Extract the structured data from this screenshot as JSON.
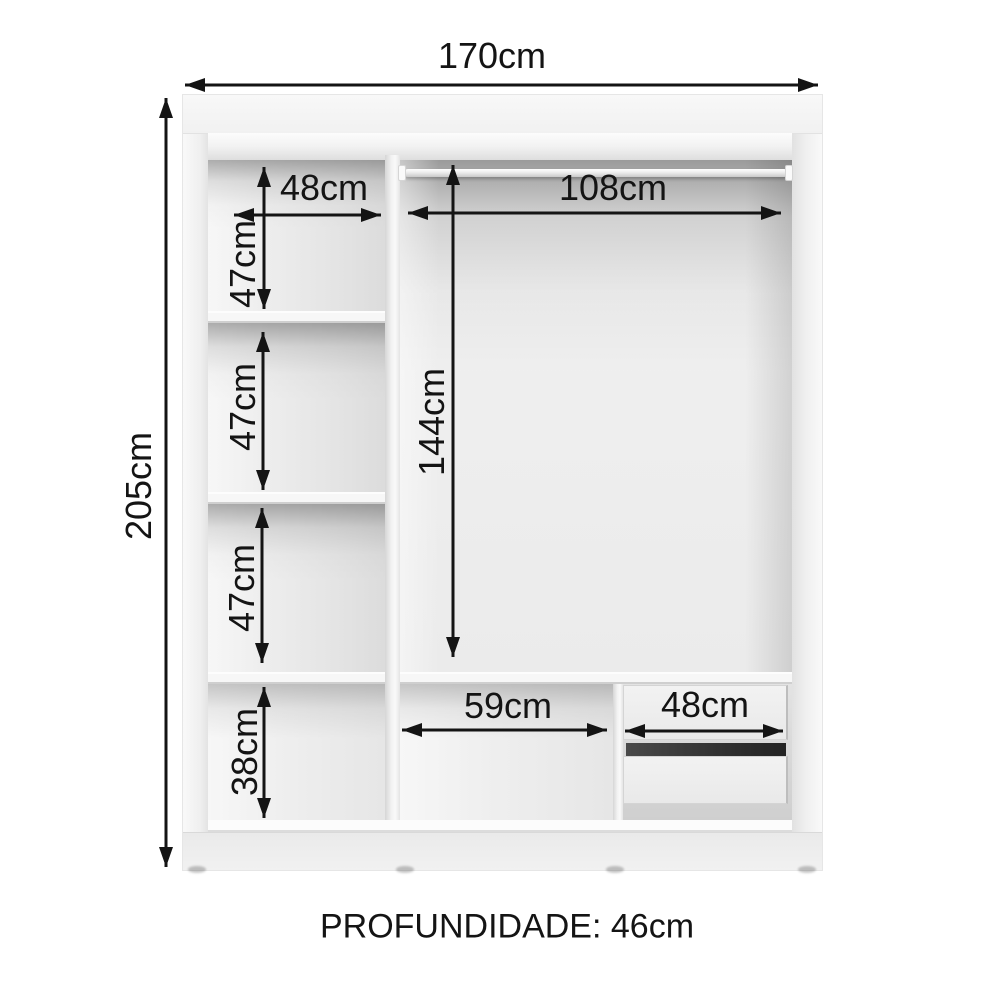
{
  "diagram": {
    "kind": "wardrobe interior dimension diagram",
    "measurements": {
      "total_width": "170cm",
      "total_height": "205cm",
      "left_column_width": "48cm",
      "left_compartment_1_height": "47cm",
      "left_compartment_2_height": "47cm",
      "left_compartment_3_height": "47cm",
      "left_bottom_compartment_height": "38cm",
      "right_section_width": "108cm",
      "right_section_height": "144cm",
      "bottom_open_compartment_width": "59cm",
      "drawer_unit_width": "48cm"
    },
    "footer": {
      "depth_label": "PROFUNDIDADE: 46cm"
    },
    "colors": {
      "background": "#ffffff",
      "arrow_and_text": "#141414",
      "cabinet_surface": "#f3f3f3",
      "interior_shadow": "#a8a8a8",
      "drawer_gap": "#2e2e2e"
    }
  }
}
